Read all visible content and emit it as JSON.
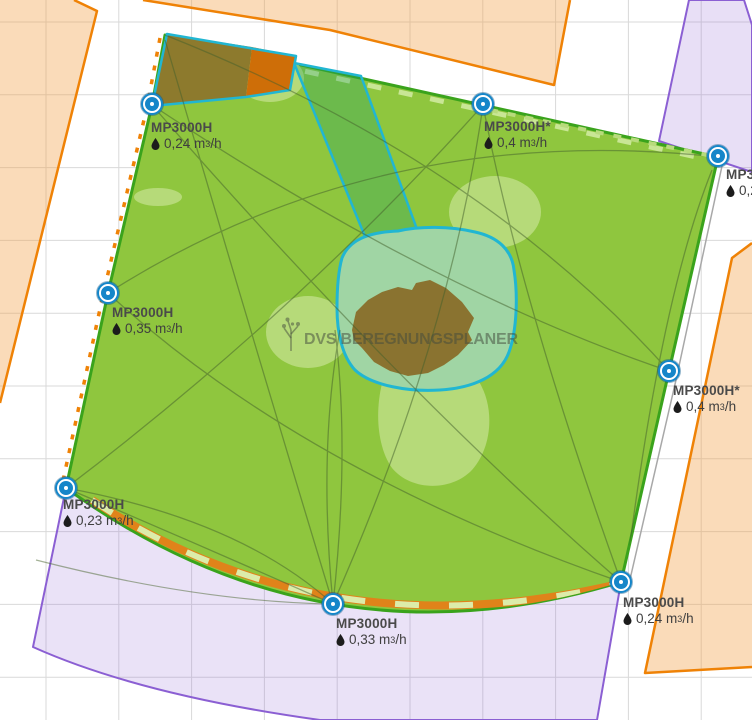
{
  "watermark": {
    "text": "DVS BEREGNUNGSPLANER"
  },
  "unit": {
    "base": "m",
    "exp": "3",
    "per": "/h"
  },
  "sprinklers": [
    {
      "name": "MP3000H",
      "flow": "0,24"
    },
    {
      "name": "MP3000H*",
      "flow": "0,4"
    },
    {
      "name": "MP3000H",
      "flow": "0,2"
    },
    {
      "name": "MP3000H",
      "flow": "0,35"
    },
    {
      "name": "MP3000H*",
      "flow": "0,4"
    },
    {
      "name": "MP3000H",
      "flow": "0,23"
    },
    {
      "name": "MP3000H",
      "flow": "0,33"
    },
    {
      "name": "MP3000H",
      "flow": "0,24"
    }
  ],
  "colors": {
    "marker_blue": "#1586c9",
    "lawn_green": "#8fc63e",
    "lawn_border_green": "#3aa31c",
    "building_border_orange": "#ef8206",
    "building_fill_orange": "#f8dcbd",
    "coverage_border_purple": "#8b5fd3",
    "coverage_fill_purple": "#e8dff5",
    "selection_cyan": "#21b6d2",
    "soil_brown": "#8a7330",
    "label_text": "#4a4a4a"
  }
}
